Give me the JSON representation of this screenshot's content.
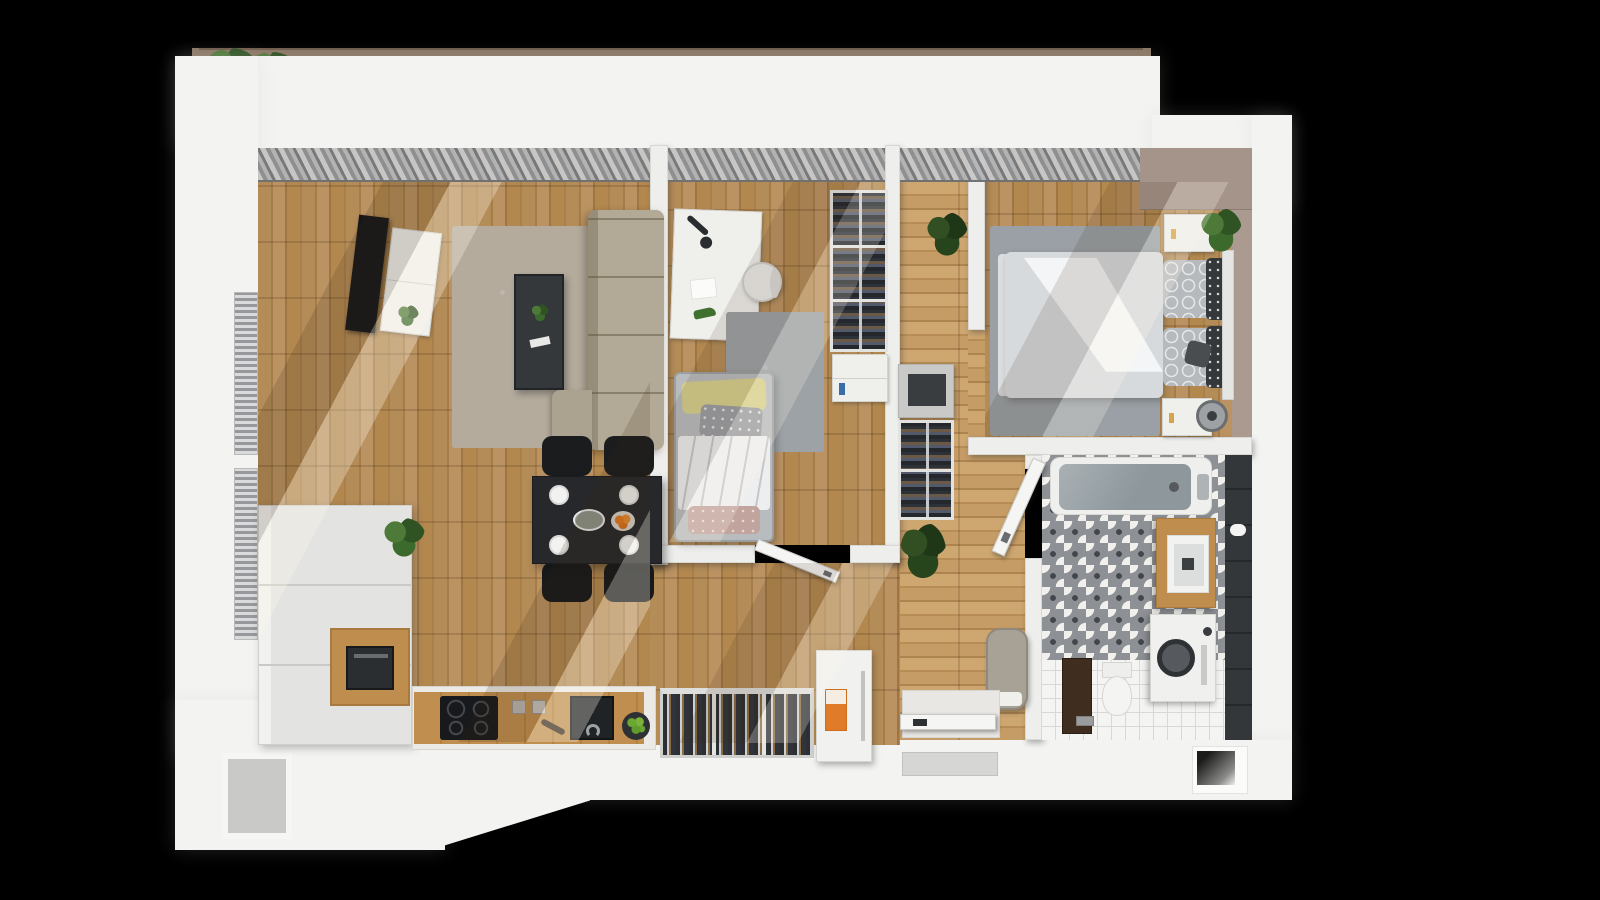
{
  "scene": {
    "type": "3d-floorplan-top-view-render",
    "visible_text": "none",
    "background_color": "#000000",
    "apartment_style": "one-bedroom apartment with open living/kitchen, study room, hallway, bedroom, bathroom and balcony"
  },
  "palette": {
    "background": "#000000",
    "wall_white": "#f3f3f1",
    "wood_floor": "#b48c58",
    "wood_floor_light": "#c59c66",
    "rug_living": "#b4ab9d",
    "rug_gray": "#9da2a6",
    "sofa_beige": "#b2aa96",
    "coffee_table_dark": "#34383b",
    "dining_table": "#26282b",
    "chair_black": "#1a1c1e",
    "curtain_gray": "#9b9da0",
    "accent_taupe": "#a5948a",
    "bath_tile_dark": "#33373a",
    "vanity_wood": "#bf8d4e",
    "tub_gray": "#8d979c",
    "plant_green": "#3c6a2d",
    "railing_brown": "#8b7765",
    "poster_orange": "#e07b2a",
    "lime_green": "#6aa832",
    "duvet_white": "#eceef0"
  },
  "rooms": [
    {
      "id": "balcony",
      "name": "balcony",
      "items": [
        "railing",
        "plants"
      ]
    },
    {
      "id": "living-kitchen",
      "name": "living room with open kitchen and dining",
      "items": [
        "wall-tv",
        "tv-cabinet",
        "area-rug",
        "coffee-table",
        "corner-sofa",
        "dining-table",
        "four-chairs",
        "tall-cabinets",
        "microwave",
        "induction-hob",
        "sink",
        "plate-rack",
        "fridge",
        "lime-bowl"
      ]
    },
    {
      "id": "study",
      "name": "kids / study room",
      "items": [
        "desk",
        "desk-lamp",
        "stool",
        "single-bed",
        "rug",
        "wardrobe",
        "dresser",
        "door"
      ]
    },
    {
      "id": "hallway",
      "name": "hallway",
      "items": [
        "console",
        "wardrobe",
        "plants",
        "pouf",
        "entrance-door",
        "doormat"
      ]
    },
    {
      "id": "bedroom",
      "name": "bedroom",
      "items": [
        "double-bed",
        "nightstand-left",
        "nightstand-right",
        "plant",
        "fan",
        "rug",
        "accent-wall"
      ]
    },
    {
      "id": "bathroom",
      "name": "bathroom",
      "items": [
        "bathtub",
        "vanity-sink",
        "washing-machine",
        "toilet",
        "patterned-tiles",
        "door"
      ]
    }
  ]
}
